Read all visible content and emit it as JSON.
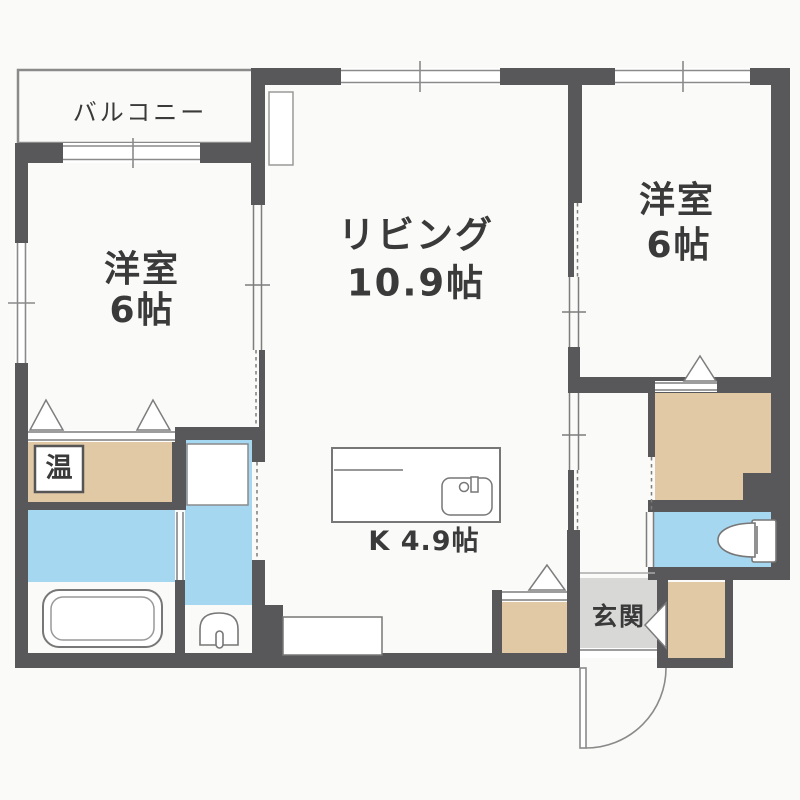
{
  "rooms": {
    "balcony": {
      "name": "バルコニー"
    },
    "bedroom_left": {
      "name": "洋室",
      "size": "6帖"
    },
    "living": {
      "name": "リビング",
      "size": "10.9帖"
    },
    "bedroom_right": {
      "name": "洋室",
      "size": "6帖"
    },
    "kitchen": {
      "name": "K 4.9帖"
    },
    "entrance": {
      "name": "玄関"
    },
    "water_heater": {
      "name": "温"
    }
  },
  "colors": {
    "wall": "#58585a",
    "closet_tan": "#e2c9a6",
    "water_blue": "#a6d7f0",
    "entrance_gray": "#d8d8d6",
    "background": "#fafaf8",
    "line": "#7a7a7a",
    "text": "#3a3a3a"
  }
}
